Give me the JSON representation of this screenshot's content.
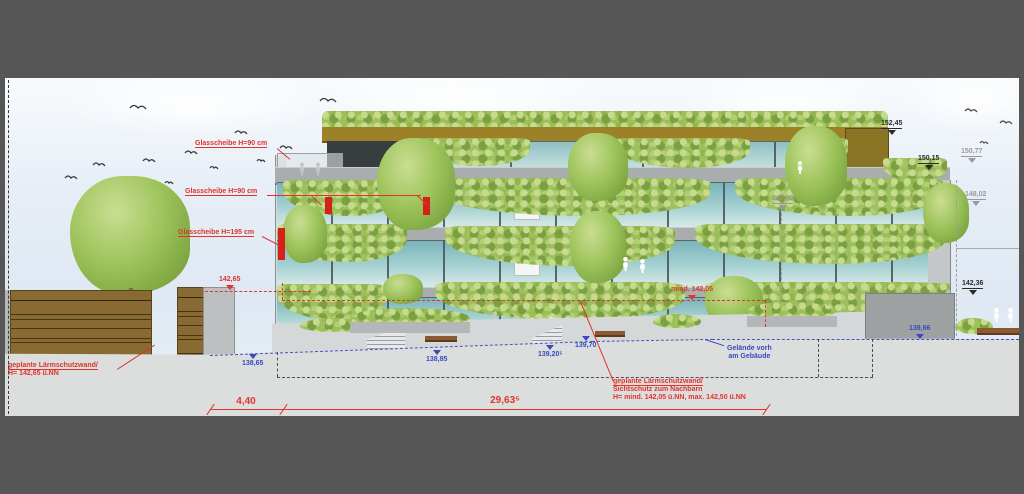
{
  "drawing_type": "building elevation (Ansicht) with green facade",
  "labels": {
    "glass1": "Glasscheibe H=90 cm",
    "glass2": "Glasscheibe H=90 cm",
    "glass3": "Glasscheibe H=195 cm",
    "wall_left_1": "geplante Lärmschutzwand/",
    "wall_left_2": "H= 142,65 ü.NN",
    "wall_right_1": "geplante Lärmschutzwand/",
    "wall_right_2": "Sichtschutz zum Nachbarn",
    "wall_right_3": "H= mind. 142,05 ü.NN, max. 142,50 ü.NN",
    "terrain_1": "Gelände vorh",
    "terrain_2": "am Gebäude",
    "min_level": "mind. 142,05",
    "level_14265": "142,65"
  },
  "levels": {
    "black": [
      "152,45",
      "150,15",
      "142,36"
    ],
    "gray": [
      "150,77",
      "148,02",
      "147,60"
    ],
    "blue": [
      "138,65",
      "138,85",
      "139,20⁵",
      "139,70",
      "139,66"
    ]
  },
  "dimensions": {
    "left": "4,40",
    "main": "29,63⁵"
  },
  "colors": {
    "annotation_red": "#e0342c",
    "annotation_blue": "#3a49c0",
    "facade_glass_teal": "#8fc3c6",
    "plants_green": "#9dbf57",
    "roof_band_olive": "#9c8128",
    "noise_wall_brown": "#8a6a33",
    "viewer_frame_gray": "#565656",
    "ground_gray": "#dcdedd"
  }
}
